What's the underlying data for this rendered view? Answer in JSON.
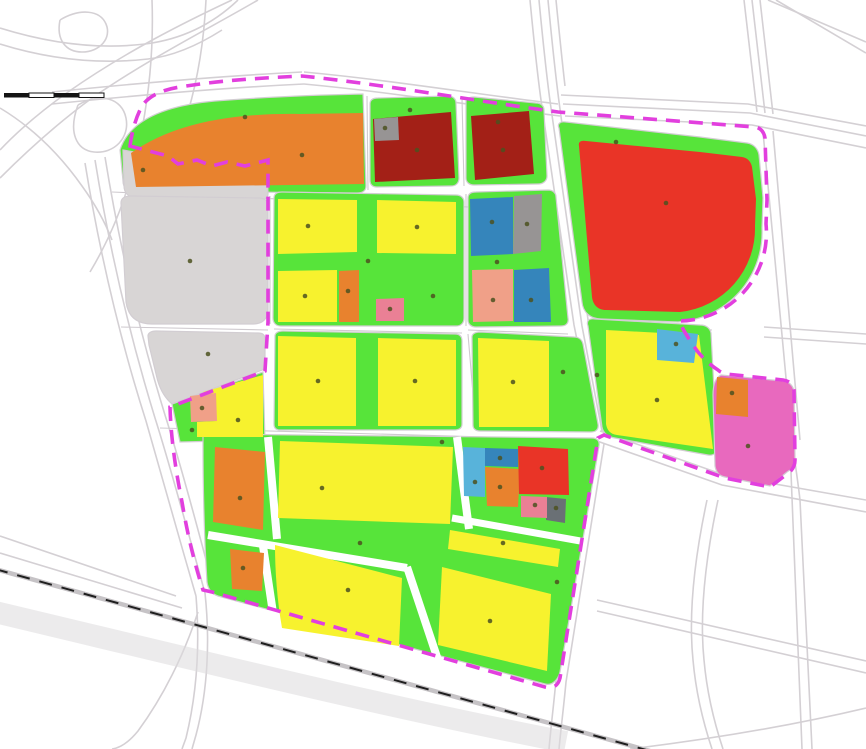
{
  "map": {
    "kind": "land-use-zoning-map",
    "scale_bar": {
      "segment_count": 4
    }
  },
  "colors": {
    "background": "#ffffff",
    "road_line": "#d4d0d4",
    "road_hairline": "#cfcacf",
    "road_fill": "#ffffff",
    "corridor_gray": "#dcdadc",
    "railway_base": "#c6c3c6",
    "railway_black": "#1f1f1f",
    "boundary_magenta": "#e23fde",
    "block_casing": "#d2cdd2",
    "scalebar_black": "#141414",
    "label_dot": "#4d5220",
    "yellow": "#f7f22e",
    "green": "#57e43a",
    "orange": "#e8822e",
    "dark_red": "#a32017",
    "red": "#e93427",
    "blue": "#3585bb",
    "light_blue": "#58b3da",
    "gray_light": "#d8d5d5",
    "gray_mid": "#979494",
    "gray_dark": "#6a7075",
    "salmon": "#f0a088",
    "rose": "#ea8095",
    "pink": "#e869be"
  }
}
